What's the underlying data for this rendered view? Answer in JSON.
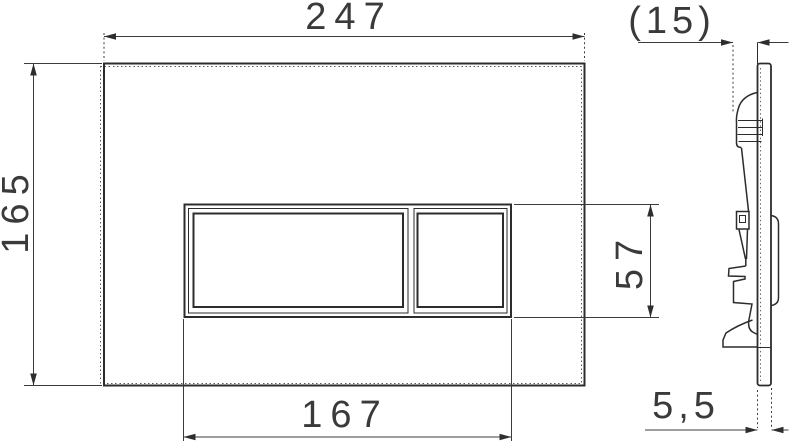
{
  "drawing": {
    "type": "technical-dimension-drawing",
    "subject": "wc-flush-plate-two-buttons",
    "views": {
      "front": {
        "dims": {
          "overall_width": "247",
          "overall_height": "165",
          "button_panel_width": "167",
          "button_panel_height": "57"
        }
      },
      "side": {
        "dims": {
          "mounting_depth": "(15)",
          "plate_thickness": "5,5"
        }
      }
    }
  },
  "colors": {
    "background": "#ffffff",
    "object_line": "#2c2c2c",
    "dimension_line": "#3c3c3c",
    "text": "#3a3a3a"
  }
}
